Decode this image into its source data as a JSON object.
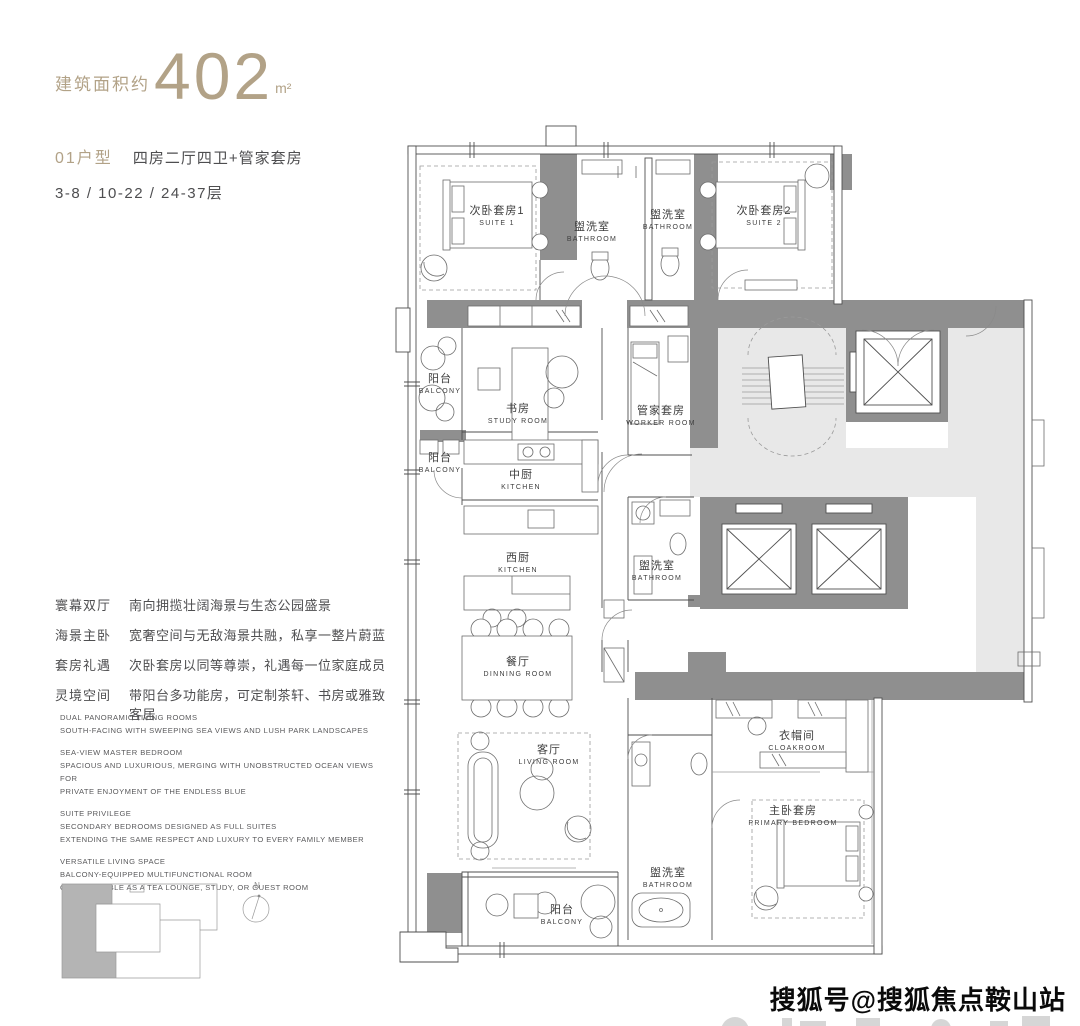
{
  "header": {
    "area_label": "建筑面积约",
    "area_value": "402",
    "area_unit": "m²",
    "unit_code": "01户型",
    "unit_layout": "四房二厅四卫+管家套房",
    "floors": "3-8 / 10-22 / 24-37层"
  },
  "features": [
    {
      "label": "寰幕双厅",
      "desc": "南向拥揽壮阔海景与生态公园盛景"
    },
    {
      "label": "海景主卧",
      "desc": "宽奢空间与无敌海景共融，私享一整片蔚蓝"
    },
    {
      "label": "套房礼遇",
      "desc": "次卧套房以同等尊崇，礼遇每一位家庭成员"
    },
    {
      "label": "灵境空间",
      "desc": "带阳台多功能房，可定制茶轩、书房或雅致客居"
    }
  ],
  "features_en": [
    {
      "text": "DUAL PANORAMIC LIVING ROOMS\nSOUTH-FACING WITH SWEEPING SEA VIEWS AND LUSH PARK LANDSCAPES"
    },
    {
      "text": "SEA-VIEW MASTER BEDROOM\nSPACIOUS AND LUXURIOUS, MERGING WITH UNOBSTRUCTED OCEAN VIEWS FOR\nPRIVATE ENJOYMENT OF THE ENDLESS BLUE"
    },
    {
      "text": "SUITE PRIVILEGE\nSECONDARY BEDROOMS DESIGNED AS FULL SUITES\nEXTENDING THE SAME RESPECT AND LUXURY TO EVERY FAMILY MEMBER"
    },
    {
      "text": "VERSATILE LIVING SPACE\nBALCONY-EQUIPPED MULTIFUNCTIONAL ROOM\nCUSTOMIZABLE AS A TEA LOUNGE, STUDY, OR GUEST ROOM"
    }
  ],
  "rooms": [
    {
      "cn": "次卧套房1",
      "en": "SUITE 1"
    },
    {
      "cn": "盥洗室",
      "en": "BATHROOM"
    },
    {
      "cn": "盥洗室",
      "en": "BATHROOM"
    },
    {
      "cn": "次卧套房2",
      "en": "SUITE 2"
    },
    {
      "cn": "阳台",
      "en": "BALCONY"
    },
    {
      "cn": "书房",
      "en": "STUDY ROOM"
    },
    {
      "cn": "管家套房",
      "en": "WORKER ROOM"
    },
    {
      "cn": "阳台",
      "en": "BALCONY"
    },
    {
      "cn": "中厨",
      "en": "KITCHEN"
    },
    {
      "cn": "西厨",
      "en": "KITCHEN"
    },
    {
      "cn": "盥洗室",
      "en": "BATHROOM"
    },
    {
      "cn": "餐厅",
      "en": "DINNING ROOM"
    },
    {
      "cn": "客厅",
      "en": "LIVING ROOM"
    },
    {
      "cn": "盥洗室",
      "en": "BATHROOM"
    },
    {
      "cn": "衣帽间",
      "en": "CLOAKROOM"
    },
    {
      "cn": "主卧套房",
      "en": "PRIMARY BEDROOM"
    },
    {
      "cn": "阳台",
      "en": "BALCONY"
    }
  ],
  "compass": {
    "label": "N"
  },
  "watermark": {
    "text": "搜狐号@搜狐焦点鞍山站"
  },
  "colors": {
    "accent": "#b2a287",
    "text_dark": "#4e4e50",
    "wall_gray": "#8f8f8f",
    "floor_gray": "#e8e8e8"
  }
}
